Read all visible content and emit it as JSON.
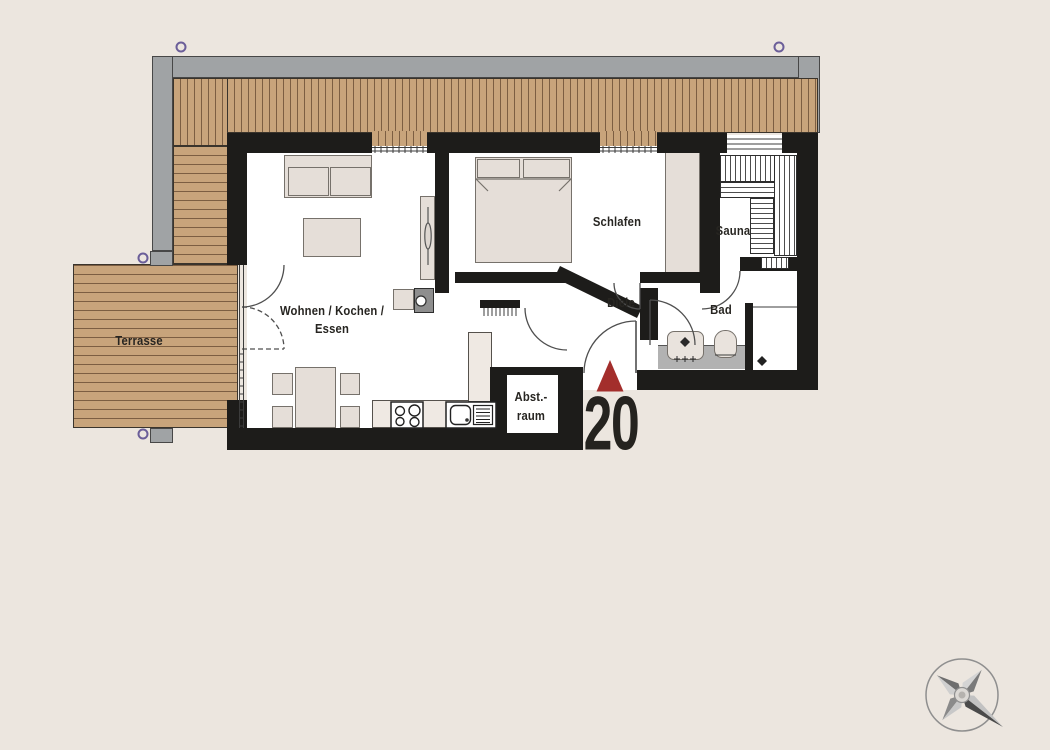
{
  "unit": {
    "number": "20"
  },
  "rooms": {
    "terrasse": "Terrasse",
    "wohnen_line1": "Wohnen / Kochen /",
    "wohnen_line2": "Essen",
    "schlafen": "Schlafen",
    "sauna": "Sauna",
    "diele": "Diele",
    "bad": "Bad",
    "abstellraum_line1": "Abst.-",
    "abstellraum_line2": "raum"
  },
  "colors": {
    "background": "#ece6df",
    "wall": "#1d1c1a",
    "wood": "#c8a47b",
    "eaves_gray": "#a0a3a5",
    "floor_white": "#ffffff",
    "furniture_fill": "#e5ded8",
    "counter_gray": "#b2b2b2",
    "entrance_red": "#a32e2c",
    "marker_purple": "#6b5e99"
  },
  "icons": {
    "compass": "compass-rose",
    "entrance": "entrance-arrow"
  }
}
